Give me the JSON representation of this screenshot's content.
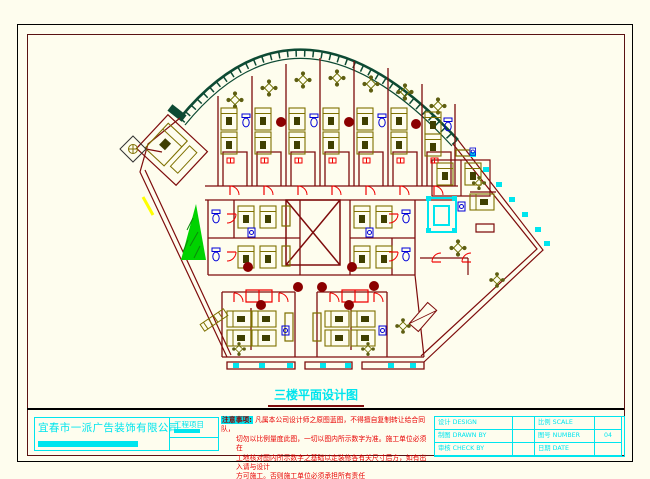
{
  "plan": {
    "title": "三楼平面设计图"
  },
  "titleblock": {
    "company": "宜春市一派广告装饰有限公司",
    "project_label": "工程项目",
    "notes_heading": "注意事项:",
    "notes": [
      "凡属本公司设计师之原图蓝图，不得擅自复制转让给合同队，",
      "切勿以比例量度此图，一切以图内所示数字为准。施工单位必须在",
      "工地核对图内所示数字之基础以定装修各有关尺寸后方，如有出入请与设计",
      "方可施工。否则施工单位必须承担所有责任"
    ],
    "table": {
      "rows": [
        {
          "cn1": "设计",
          "en1": "DESIGN",
          "v1": "",
          "cn2": "比例",
          "en2": "SCALE",
          "v2": ""
        },
        {
          "cn1": "制图",
          "en1": "DRAWN BY",
          "v1": "",
          "cn2": "图号",
          "en2": "NUMBER",
          "v2": "04"
        },
        {
          "cn1": "审核",
          "en1": "CHECK BY",
          "v1": "",
          "cn2": "日期",
          "en2": "DATE",
          "v2": ""
        }
      ]
    }
  },
  "colors": {
    "background": "#FEFDEE",
    "outer_frame": "#000000",
    "inner_frame": "#5A1212",
    "wall_maroon": "#7E0C0C",
    "furniture_olive": "#7E7000",
    "furniture_dark": "#3F3F00",
    "curtain_wall_green": "#0D4A33",
    "door_red": "#F00000",
    "fixture_blue": "#0000D8",
    "accent_cyan": "#00E5EE",
    "plant_green": "#00D300",
    "mark_yellow": "#FFFF00",
    "table_circle_darkred": "#8B0000"
  }
}
